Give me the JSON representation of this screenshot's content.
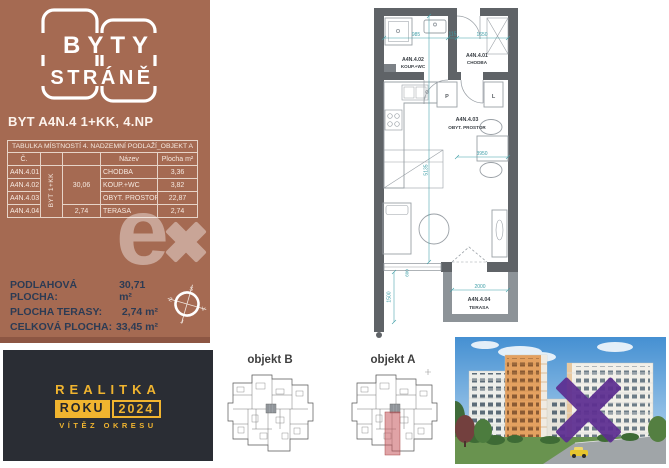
{
  "brand": {
    "logo_top": "BYTY",
    "logo_bottom": "STRÁNĚ"
  },
  "title": "BYT A4N.4 1+KK, 4.NP",
  "table": {
    "caption": "TABULKA MÍSTNOSTÍ 4. NADZEMNÍ PODLAŽÍ_OBJEKT A",
    "col_number": "Č.",
    "col_name": "Název",
    "col_area": "Plocha m²",
    "unit": "BYT 1+KK",
    "unit_area": "30,06",
    "terrace_area": "2,74",
    "rows": [
      {
        "number": "A4N.4.01",
        "name": "CHODBA",
        "area": "3,36"
      },
      {
        "number": "A4N.4.02",
        "name": "KOUP.+WC",
        "area": "3,82"
      },
      {
        "number": "A4N.4.03",
        "name": "OBYT. PROSTOR",
        "area": "22,87"
      },
      {
        "number": "A4N.4.04",
        "name": "TERASA",
        "area": "2,74"
      }
    ]
  },
  "summary": {
    "floor_label": "PODLAHOVÁ PLOCHA:",
    "floor_value": "30,71 m²",
    "terrace_label": "PLOCHA TERASY:",
    "terrace_value": "2,74 m²",
    "total_label": "CELKOVÁ PLOCHA:",
    "total_value": "33,45 m²"
  },
  "compass": {
    "n": "S",
    "s": "J",
    "e": "V",
    "w": "Z"
  },
  "plan": {
    "room1_id": "A4N.4.01",
    "room1_name": "CHODBA",
    "room2_id": "A4N.4.02",
    "room2_name": "KOUP.+WC",
    "room3_id": "A4N.4.03",
    "room3_name": "OBYT. PROSTOR",
    "room4_id": "A4N.4.04",
    "room4_name": "TERASA",
    "washer": "P",
    "fridge": "L",
    "dim_top_left": "985",
    "dim_top_mid": "115",
    "dim_top_right": "1650",
    "dim_width": "3950",
    "dim_height": "5135",
    "dim_door": "600",
    "dim_terrace_w": "2000",
    "dim_terrace_h": "1500"
  },
  "badge": {
    "line1": "REALITKA",
    "word": "ROKU",
    "year": "2024",
    "line3": "VÍTĚZ OKRESU"
  },
  "thumbs": {
    "left": "objekt B",
    "right": "objekt A"
  },
  "watermark": {
    "e": "e",
    "p": "p"
  }
}
